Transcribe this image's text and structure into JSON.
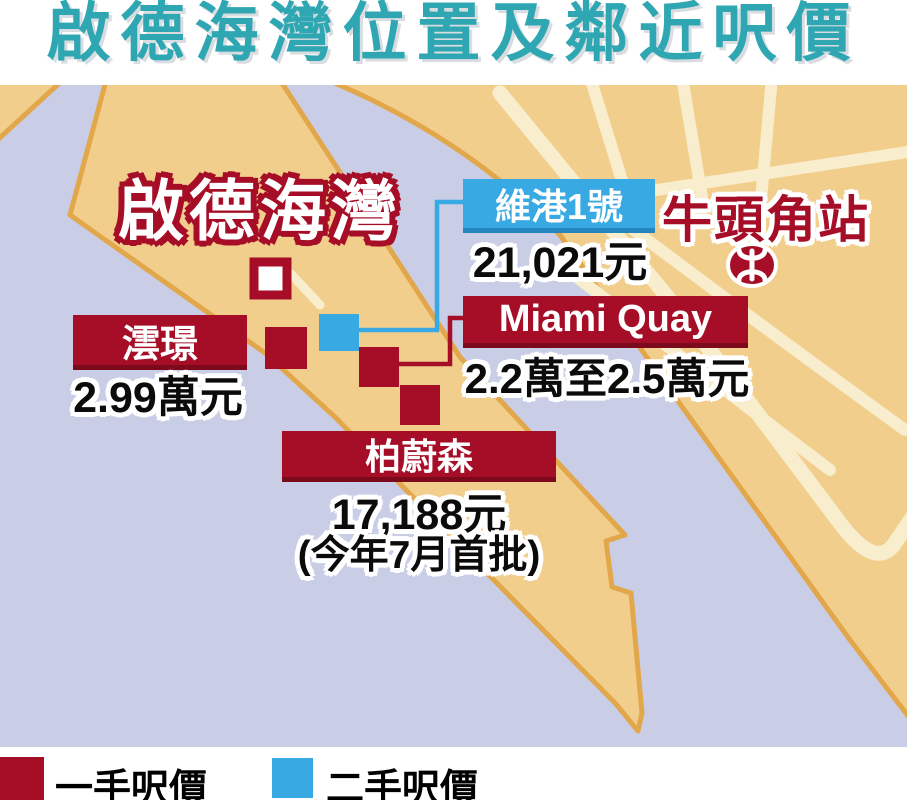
{
  "title": "啟德海灣位置及鄰近呎價",
  "map": {
    "area_label": "啟德海灣",
    "station": {
      "name": "牛頭角站",
      "icon": "mtr-logo"
    },
    "projects": [
      {
        "name": "澐璟",
        "price": "2.99萬元",
        "market": "一手"
      },
      {
        "name": "維港1號",
        "price": "21,021元",
        "market": "二手"
      },
      {
        "name": "Miami Quay",
        "price": "2.2萬至2.5萬元",
        "market": "一手"
      },
      {
        "name": "柏蔚森",
        "price": "17,188元",
        "note": "(今年7月首批)",
        "market": "一手"
      }
    ]
  },
  "legend": {
    "items": [
      {
        "label": "一手呎價",
        "color": "#a60e28"
      },
      {
        "label": "二手呎價",
        "color": "#38a9e2"
      }
    ]
  },
  "colors": {
    "headline_teal": "#2fa7b2",
    "water": "#c9cde6",
    "land": "#f2ce8d",
    "land_border": "#e2a74a",
    "road": "#f8edcc",
    "first_hand_red": "#a60e28",
    "second_hand_blue": "#38a9e2"
  },
  "chart_data": {
    "type": "table",
    "title": "啟德海灣位置及鄰近呎價",
    "columns": [
      "項目",
      "呎價",
      "市場類別"
    ],
    "rows": [
      [
        "澐璟",
        "2.99萬元",
        "一手呎價"
      ],
      [
        "維港1號",
        "21,021元",
        "二手呎價"
      ],
      [
        "Miami Quay",
        "2.2萬至2.5萬元",
        "一手呎價"
      ],
      [
        "柏蔚森",
        "17,188元 (今年7月首批)",
        "一手呎價"
      ],
      [
        "牛頭角站",
        "",
        "MTR站"
      ]
    ]
  }
}
